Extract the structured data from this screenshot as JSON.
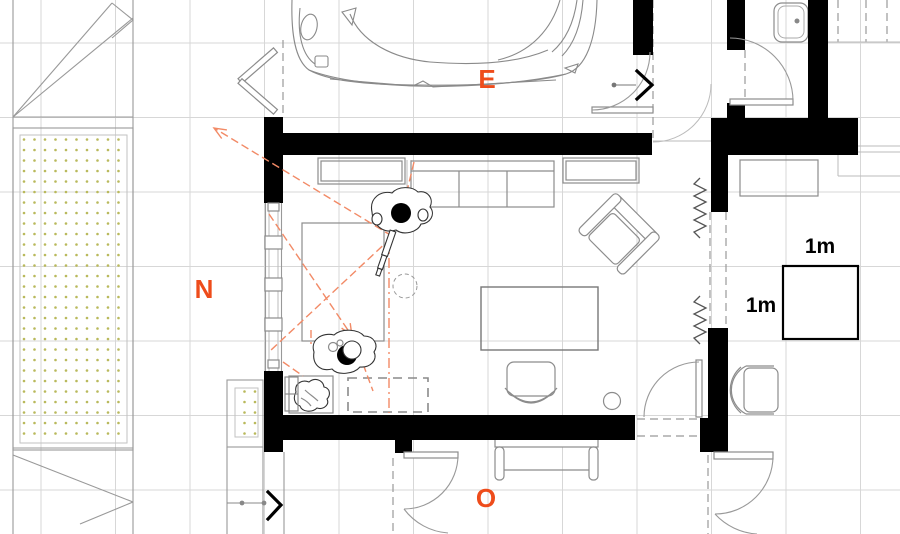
{
  "compass": {
    "east": "E",
    "north": "N",
    "west": "O"
  },
  "scale_indicator": {
    "top_label": "1m",
    "left_label": "1m"
  },
  "colors": {
    "accent": "#ee4c1b",
    "sight_line": "#f28a66",
    "wall": "#000000",
    "furniture": "#8c8c8c",
    "structure": "#999999",
    "grid": "#d7d7d7",
    "vegetation_dots": "#b9b95c"
  }
}
